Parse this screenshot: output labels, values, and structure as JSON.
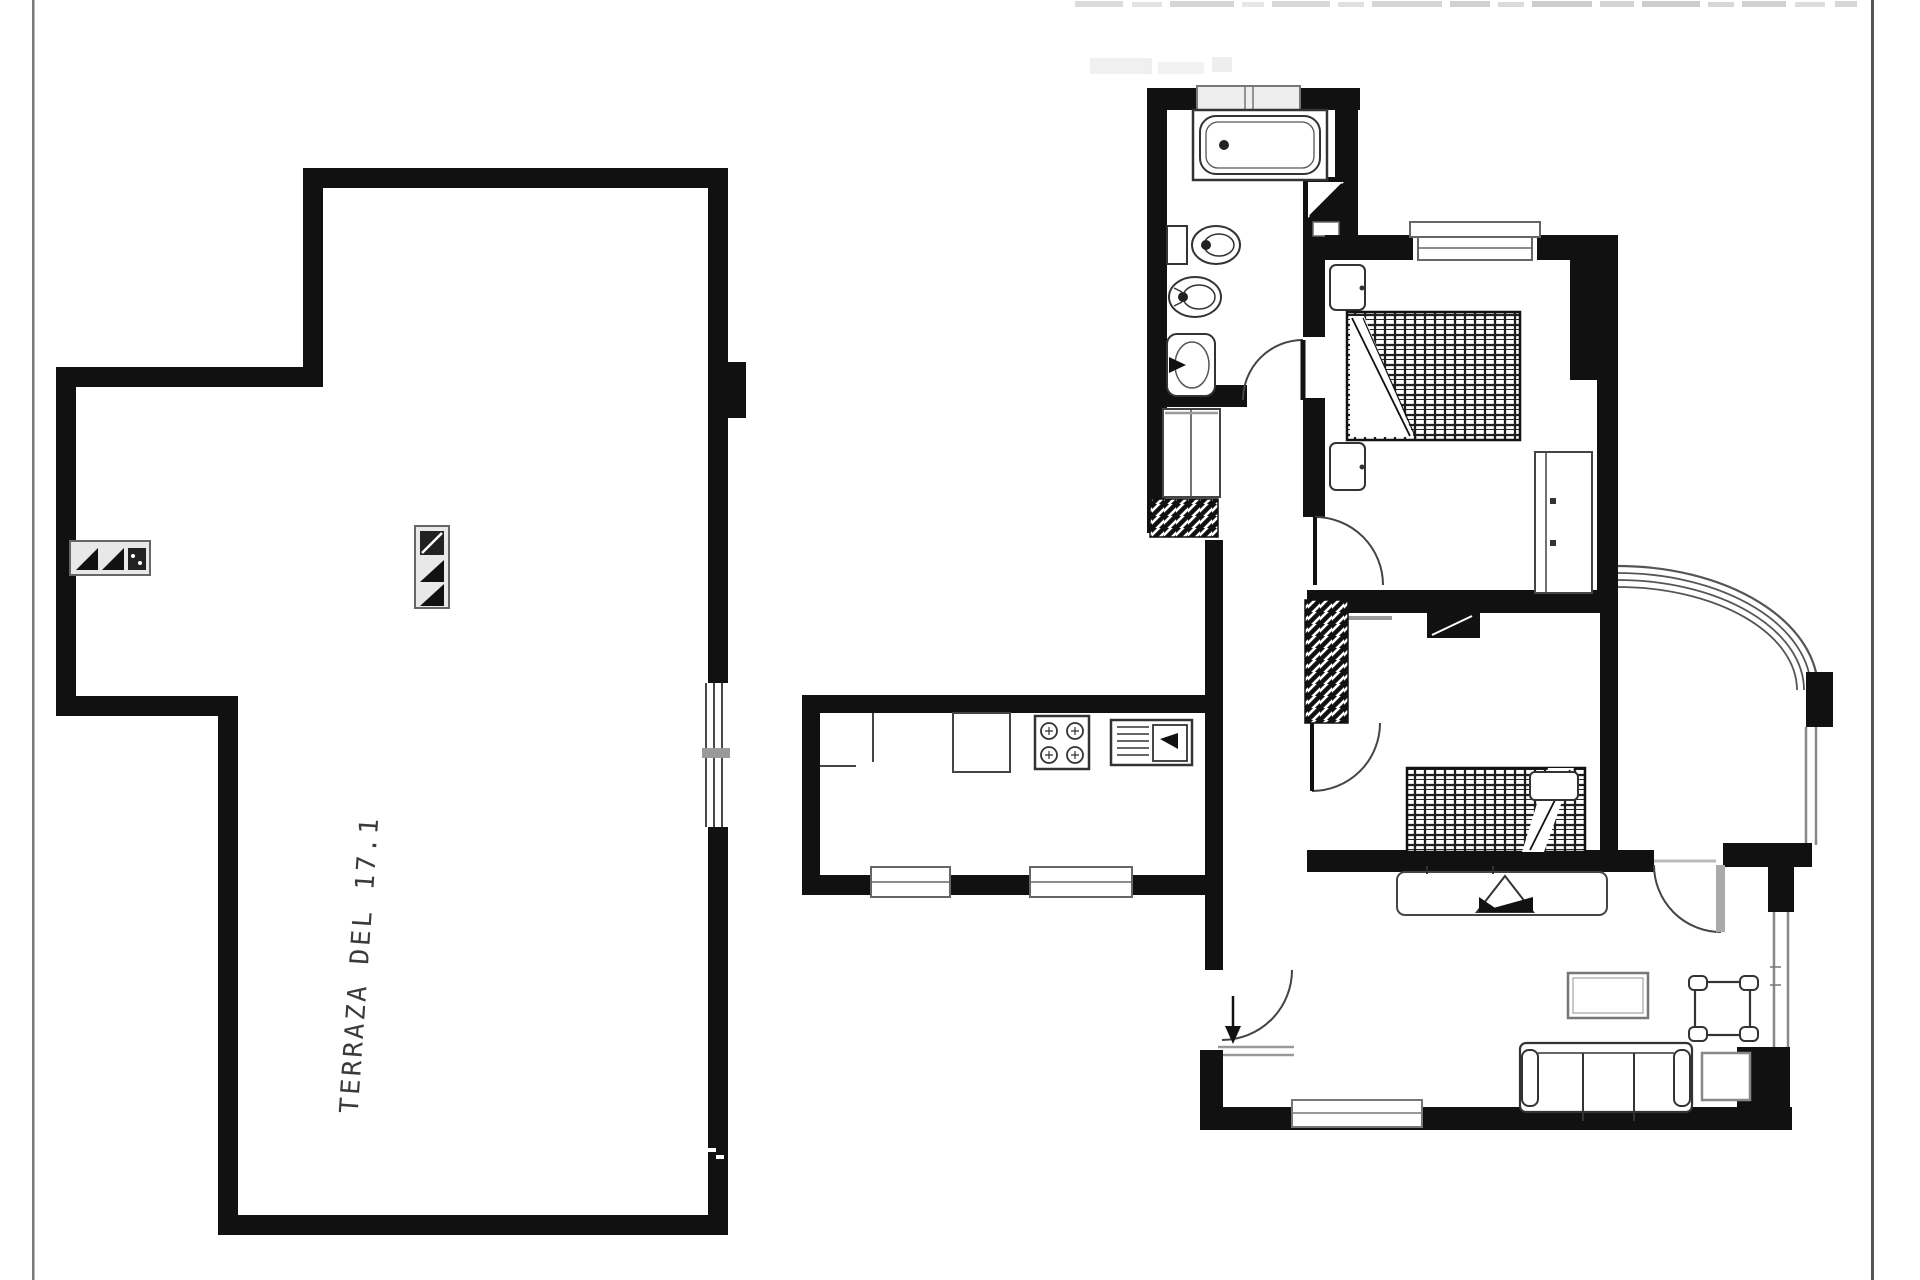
{
  "labels": {
    "terrace": "TERRAZA DEL 17.1"
  },
  "colors": {
    "ink": "#111111",
    "fixture": "#333333",
    "window_frame": "#777777",
    "sill": "#999999",
    "paper": "#ffffff",
    "page_border": "#666666",
    "smudge": "#d9d9d9"
  }
}
